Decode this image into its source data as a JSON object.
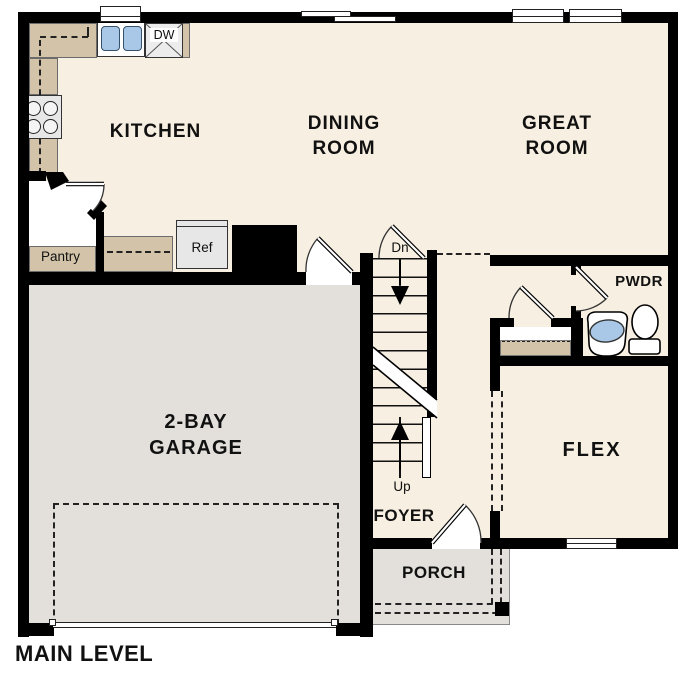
{
  "title": "MAIN LEVEL",
  "colors": {
    "wall": "#000000",
    "floor": "#f7efe1",
    "garage_floor": "#e3e0dc",
    "counter_tan": "#d3c4a9",
    "appliance_gray": "#e7e7e7",
    "fixture_blue": "#a9c8e7"
  },
  "labels": {
    "kitchen": "KITCHEN",
    "dining": [
      "DINING",
      "ROOM"
    ],
    "great": [
      "GREAT",
      "ROOM"
    ],
    "garage": [
      "2-BAY",
      "GARAGE"
    ],
    "flex": "FLEX",
    "foyer": "FOYER",
    "porch": "PORCH",
    "pwdr": "PWDR",
    "pantry": "Pantry",
    "ref": "Ref",
    "dw": "DW",
    "stairs_down": "Dn",
    "stairs_up": "Up",
    "main_level": "MAIN LEVEL"
  }
}
